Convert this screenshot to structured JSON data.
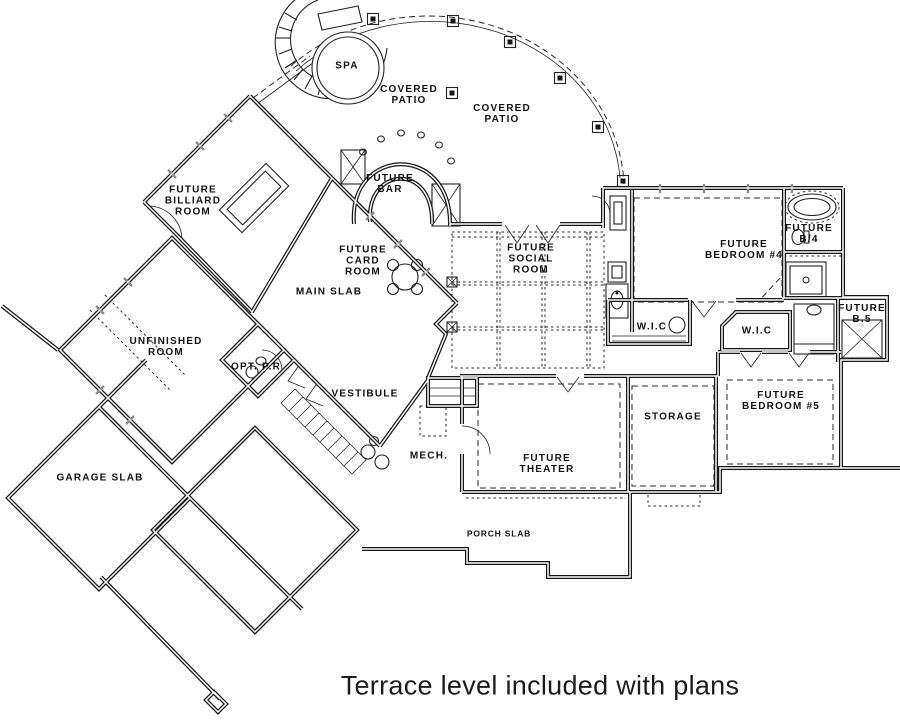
{
  "title": "Terrace level floor plan",
  "caption": "Terrace level included with plans",
  "colors": {
    "ink": "#161616",
    "paper": "#ffffff",
    "window_mark": "#8a8a8a"
  },
  "fixtures": [
    "spa-tub",
    "patio-columns",
    "bar-counter",
    "billiard-table",
    "card-table",
    "staircase",
    "bathtub",
    "shower",
    "toilet",
    "sink",
    "closet-shelves"
  ],
  "labels": [
    {
      "name": "spa",
      "text": "SPA"
    },
    {
      "name": "covered-patio-1",
      "text": "COVERED\nPATIO"
    },
    {
      "name": "covered-patio-2",
      "text": "COVERED\nPATIO"
    },
    {
      "name": "future-bar",
      "text": "FUTURE\nBAR"
    },
    {
      "name": "future-billiard-room",
      "text": "FUTURE\nBILLIARD\nROOM"
    },
    {
      "name": "future-card-room",
      "text": "FUTURE\nCARD\nROOM"
    },
    {
      "name": "main-slab",
      "text": "MAIN SLAB"
    },
    {
      "name": "future-social-room",
      "text": "FUTURE\nSOCIAL\nROOM"
    },
    {
      "name": "future-bedroom-4",
      "text": "FUTURE\nBEDROOM #4"
    },
    {
      "name": "future-b4",
      "text": "FUTURE\nB/4"
    },
    {
      "name": "wic-1",
      "text": "W.I.C"
    },
    {
      "name": "wic-2",
      "text": "W.I.C"
    },
    {
      "name": "future-b5",
      "text": "FUTURE\nB.5"
    },
    {
      "name": "future-bedroom-5",
      "text": "FUTURE\nBEDROOM #5"
    },
    {
      "name": "storage",
      "text": "STORAGE"
    },
    {
      "name": "unfinished-room",
      "text": "UNFINISHED\nROOM"
    },
    {
      "name": "opt-pr",
      "text": "OPT. P.R"
    },
    {
      "name": "vestibule",
      "text": "VESTIBULE"
    },
    {
      "name": "mech",
      "text": "MECH."
    },
    {
      "name": "future-theater",
      "text": "FUTURE\nTHEATER"
    },
    {
      "name": "garage-slab",
      "text": "GARAGE SLAB"
    },
    {
      "name": "porch-slab",
      "text": "PORCH SLAB"
    }
  ]
}
